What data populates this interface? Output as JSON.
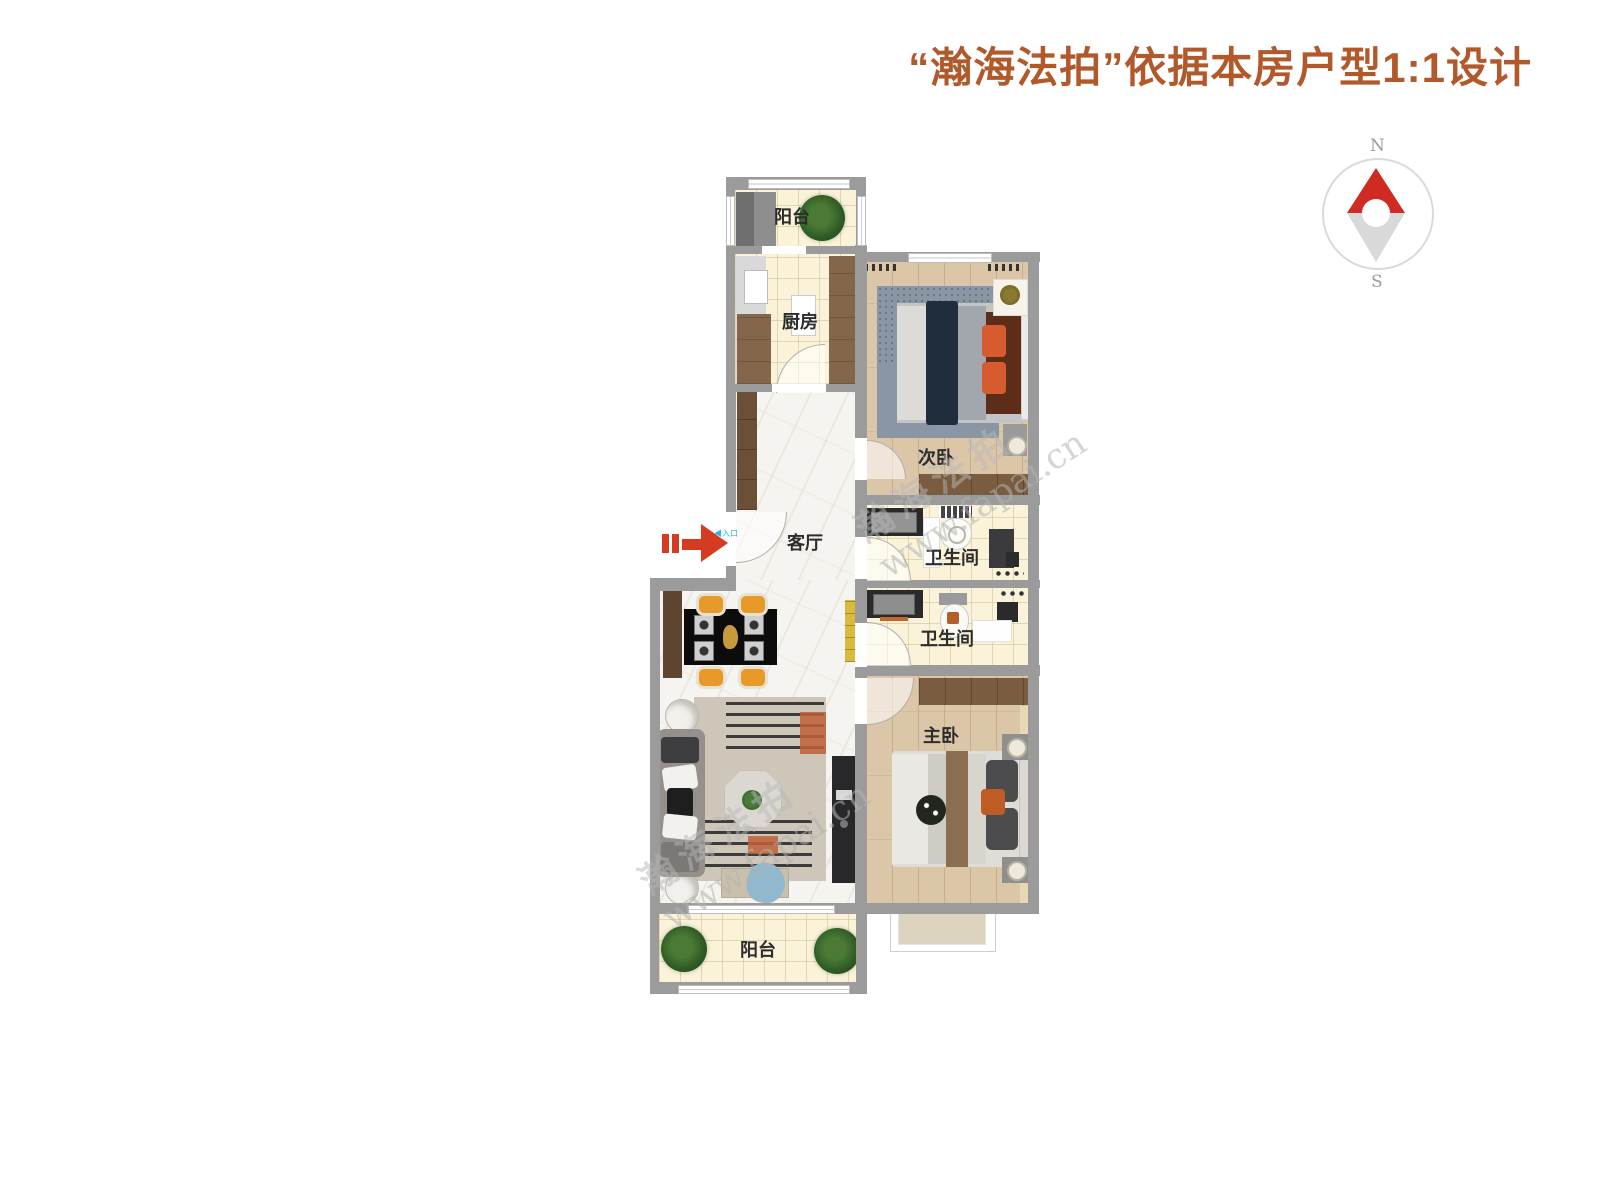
{
  "title": {
    "text": "“瀚海法拍”依据本房户型1:1设计",
    "color": "#b2592c"
  },
  "compass": {
    "north": "N",
    "south": "S",
    "needle_color": "#cf2b24"
  },
  "entrance": {
    "marker": "◀",
    "label": "入口",
    "label_color": "#2bb3d9",
    "arrow_color": "#d43b20"
  },
  "rooms": {
    "balcony_top": "阳台",
    "kitchen": "厨房",
    "bedroom_second": "次卧",
    "living": "客厅",
    "bathroom_top": "卫生间",
    "bathroom_bottom": "卫生间",
    "bedroom_master": "主卧",
    "balcony_bottom": "阳台"
  },
  "watermark": {
    "cn": "瀚海法拍",
    "url": "www.fapai.cn"
  },
  "colors": {
    "wall": "#9b9b9b",
    "tile_floor": "#faf3da",
    "wood_floor": "#dcc6a8",
    "marble_floor": "#f6f4f0"
  }
}
